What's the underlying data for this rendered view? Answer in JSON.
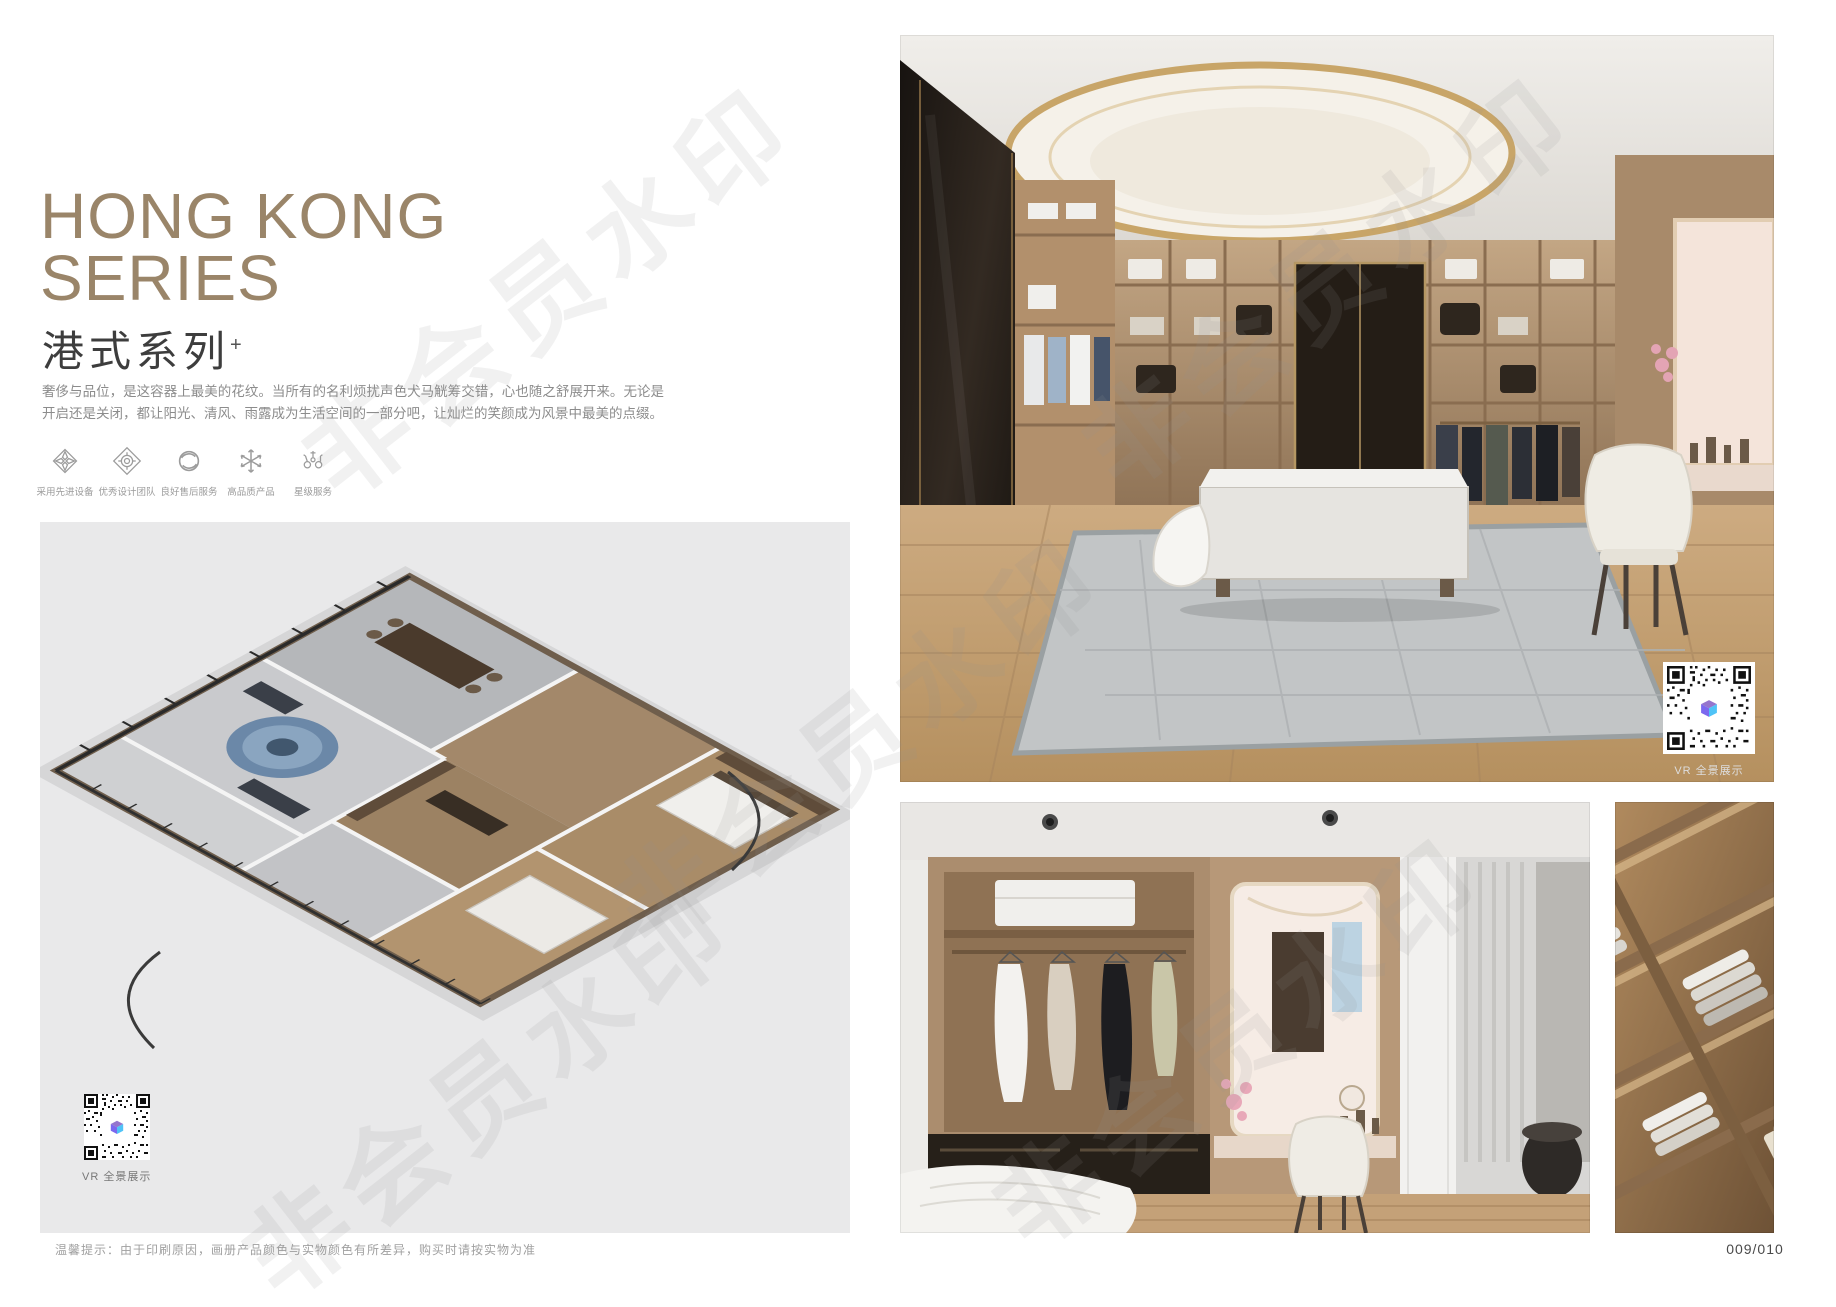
{
  "page": {
    "watermark_text": "非会员水印",
    "page_number": "009/010",
    "disclaimer": "温馨提示：由于印刷原因，画册产品颜色与实物颜色有所差异，购买时请按实物为准"
  },
  "left": {
    "title_line1": "HONG KONG",
    "title_line2": "SERIES",
    "subtitle_cn": "港式系列",
    "subtitle_sup": "+",
    "description": "奢侈与品位，是这容器上最美的花纹。当所有的名利烦扰声色犬马觥筹交错，心也随之舒展开来。无论是开启还是关闭，都让阳光、清风、雨露成为生活空间的一部分吧，让灿烂的笑颜成为风景中最美的点缀。",
    "features": [
      {
        "icon": "advanced-equipment-icon",
        "label": "采用先进设备"
      },
      {
        "icon": "design-team-icon",
        "label": "优秀设计团队"
      },
      {
        "icon": "after-sales-icon",
        "label": "良好售后服务"
      },
      {
        "icon": "quality-product-icon",
        "label": "高品质产品"
      },
      {
        "icon": "star-service-icon",
        "label": "星级服务"
      }
    ],
    "floorplan": {
      "vr_label": "VR 全景展示"
    }
  },
  "right": {
    "main_photo": {
      "vr_label": "VR 全景展示"
    }
  },
  "colors": {
    "accent": "#9a8569",
    "panel_bg": "#e9e9ea",
    "qr_logo_purple": "#7b68ee",
    "qr_logo_cyan": "#4fc3f7"
  }
}
